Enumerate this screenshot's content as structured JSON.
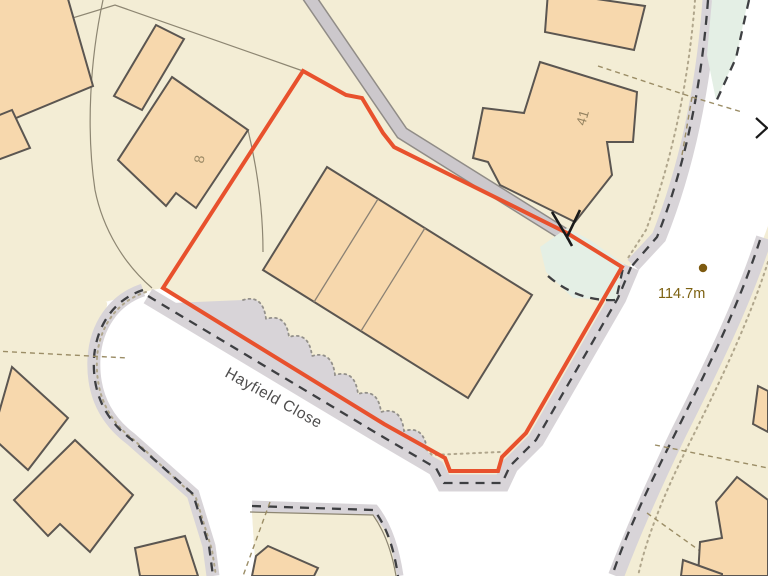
{
  "map": {
    "title": "Site location plan",
    "labels": {
      "road": "Hayfield Close",
      "spot_height": "114.7m",
      "plot_8": "8",
      "plot_41": "41"
    },
    "colors": {
      "background": "#f3edd5",
      "building_fill": "#f7d8ad",
      "building_outline": "#5b5651",
      "road_surface": "#ffffff",
      "verge_gray": "#d8d4d8",
      "footpath_gray": "#ccc8cc",
      "site_boundary_red": "#e8512d",
      "grass_green": "#e4efe5",
      "spot_height_brown": "#7d6212",
      "road_label_gray": "#4e4d4d",
      "plot_label_brown": "#9c8a66"
    },
    "icons": {
      "flow_arrow": "flow-arrow-icon",
      "edge_chevron": "chevron-arrow-icon",
      "spot_dot": "spot-height-dot"
    }
  }
}
